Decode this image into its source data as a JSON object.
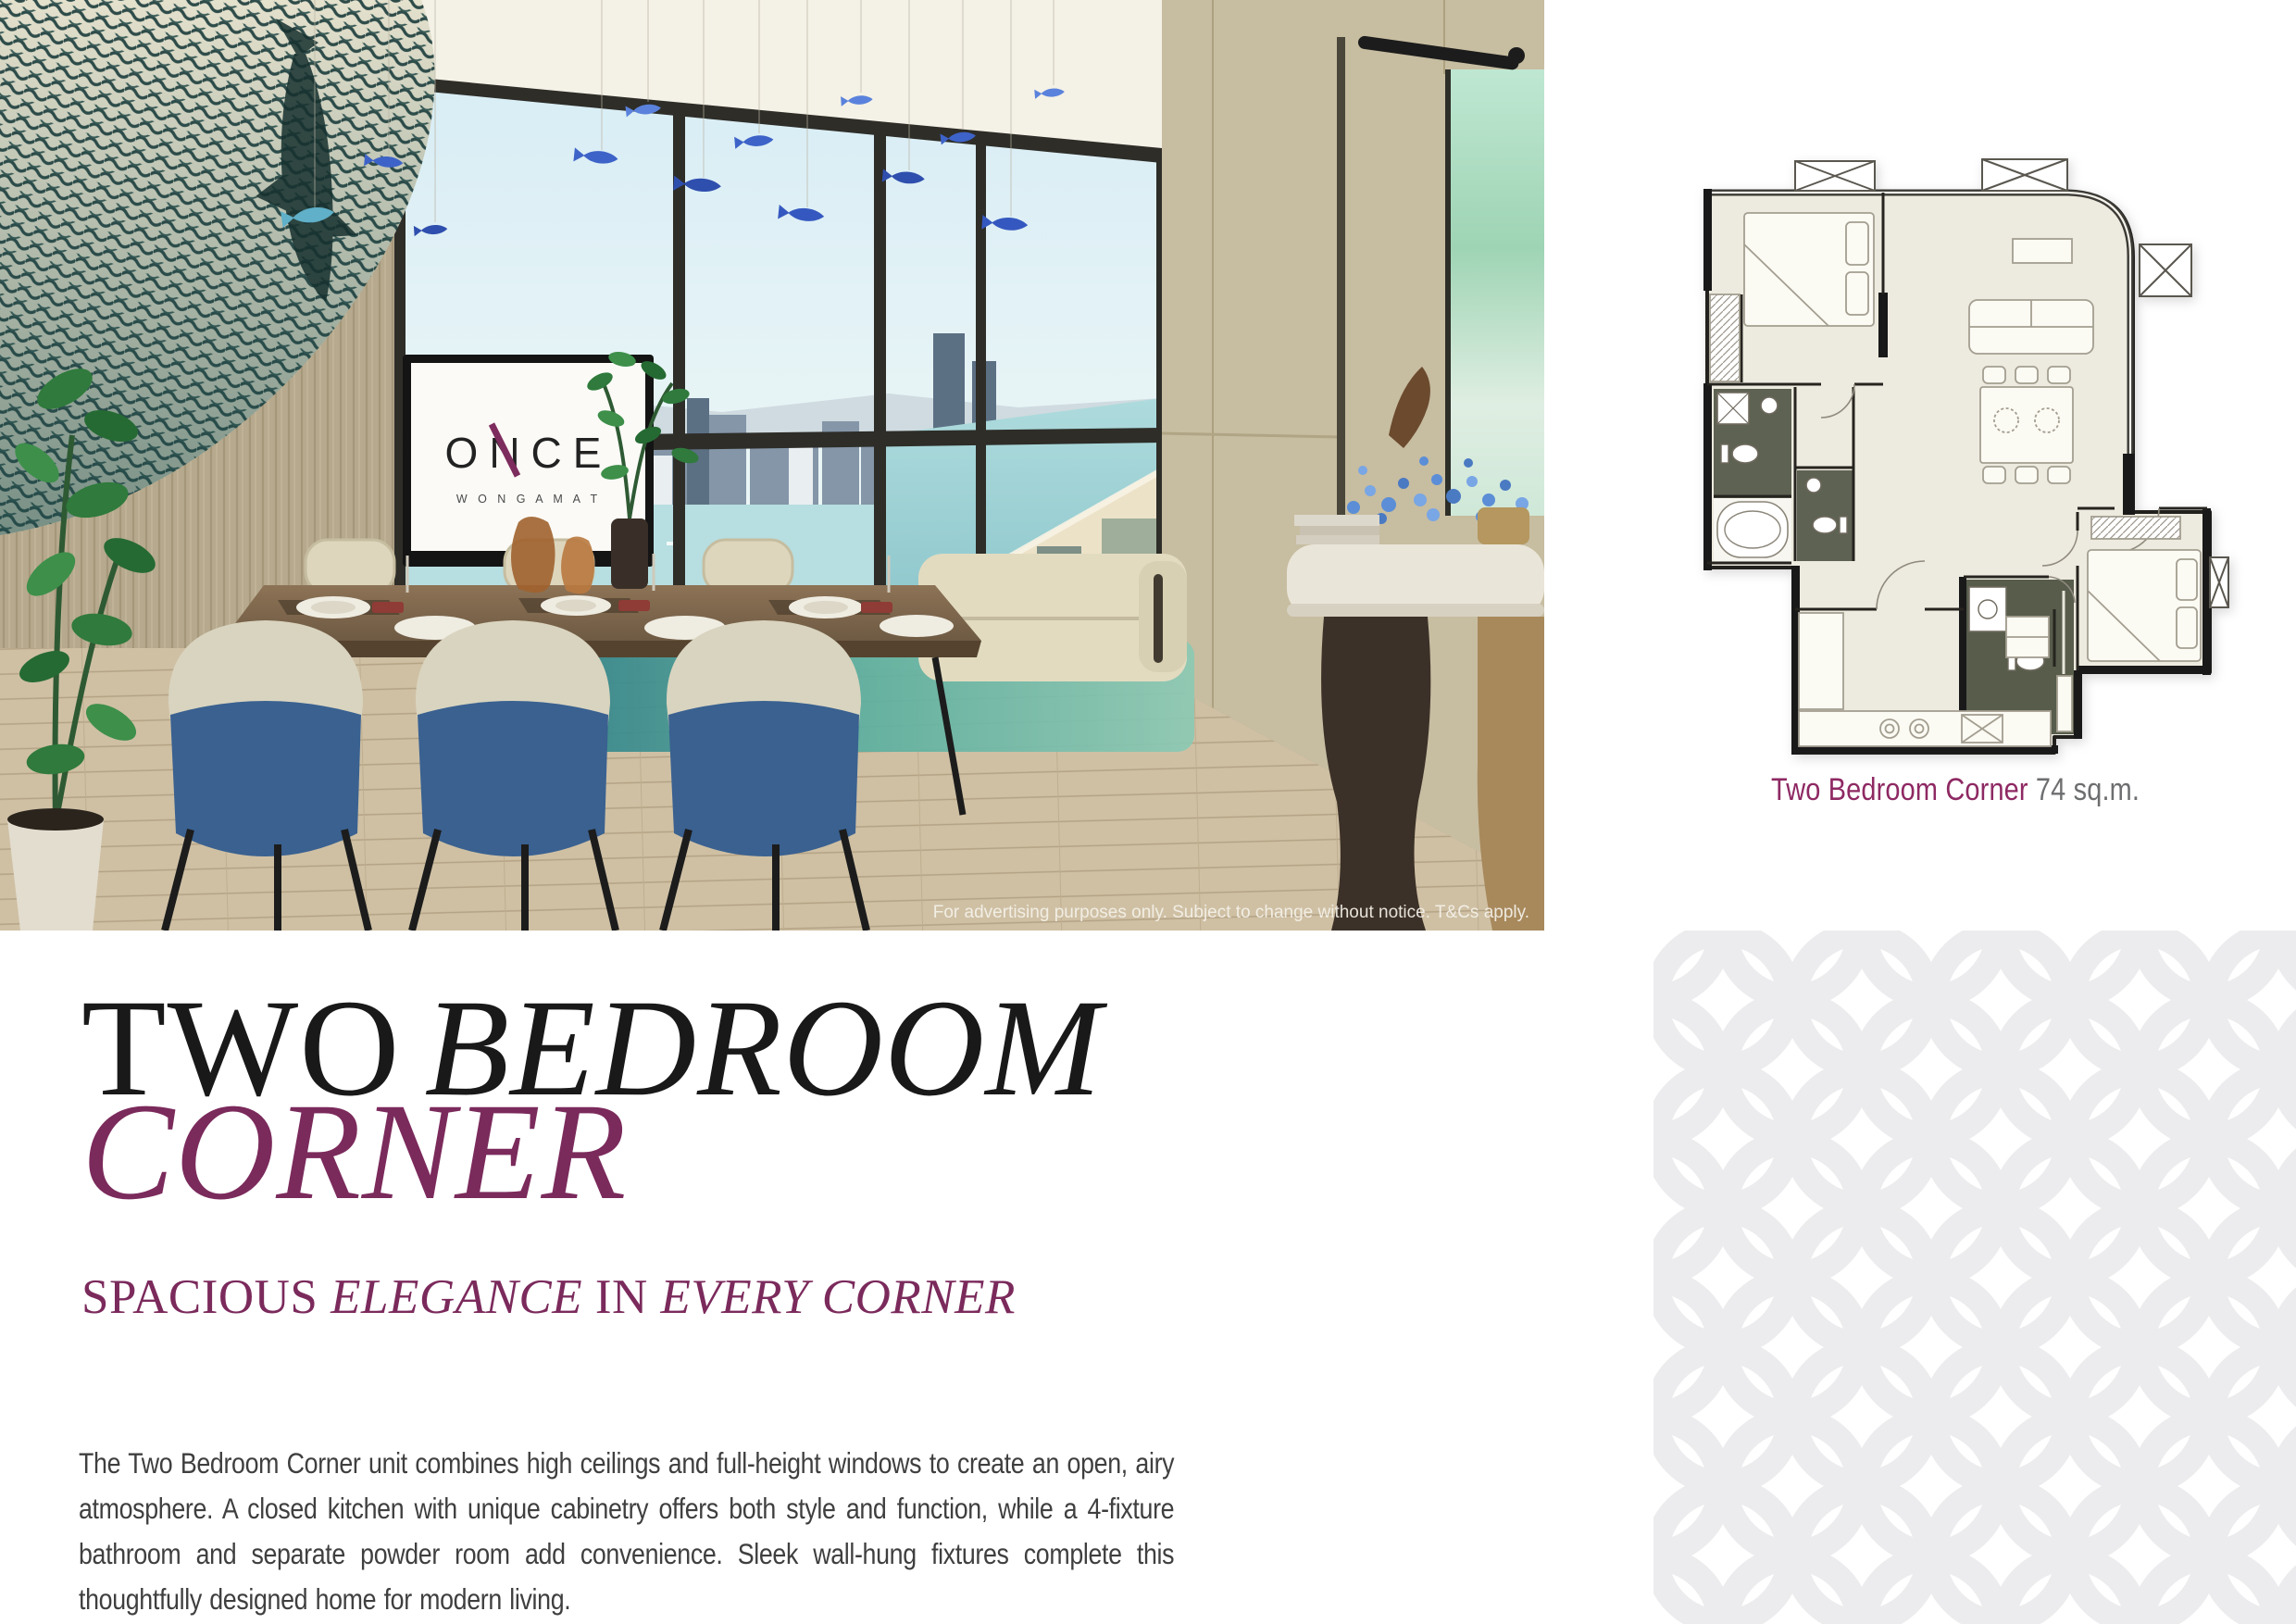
{
  "title": {
    "line1_regular": "TWO",
    "line1_italic": "BEDROOM",
    "line2_italic": "CORNER",
    "color_primary": "#191919",
    "color_accent": "#7b2a5c"
  },
  "subtitle": {
    "part1": "SPACIOUS ",
    "part2": "ELEGANCE",
    "part3": " IN ",
    "part4": "EVERY CORNER",
    "color": "#7b2a5c"
  },
  "body": {
    "paragraph": "The Two Bedroom Corner unit combines high ceilings and full-height windows to create an open, airy atmosphere. A closed kitchen with unique cabinetry offers both style and function, while a 4-fixture bathroom and separate powder room add convenience. Sleek wall-hung fixtures complete this thoughtfully designed home for modern living."
  },
  "floorplan": {
    "caption_name": "Two Bedroom Corner ",
    "caption_area": "74 sq.m.",
    "caption_name_color": "#8e2963",
    "caption_area_color": "#6d6e70",
    "floor_color": "#edeadf",
    "wet_room_color": "#5e6252",
    "wall_color": "#191919"
  },
  "photo": {
    "disclaimer": "For advertising purposes only. Subject to change without notice. T&Cs apply.",
    "tv_logo": "ONCE",
    "tv_sublogo": "W O N G A M A T",
    "accent_chair_color": "#3a6190",
    "wall_color": "#c2b69a",
    "sky_color": "#dff0f6",
    "sea_color": "#9fd1d6",
    "rug_color": "#2f8289",
    "mural_color": "#2e4b49"
  },
  "pattern": {
    "motif": "overlapping-circles",
    "color": "#ececee"
  }
}
